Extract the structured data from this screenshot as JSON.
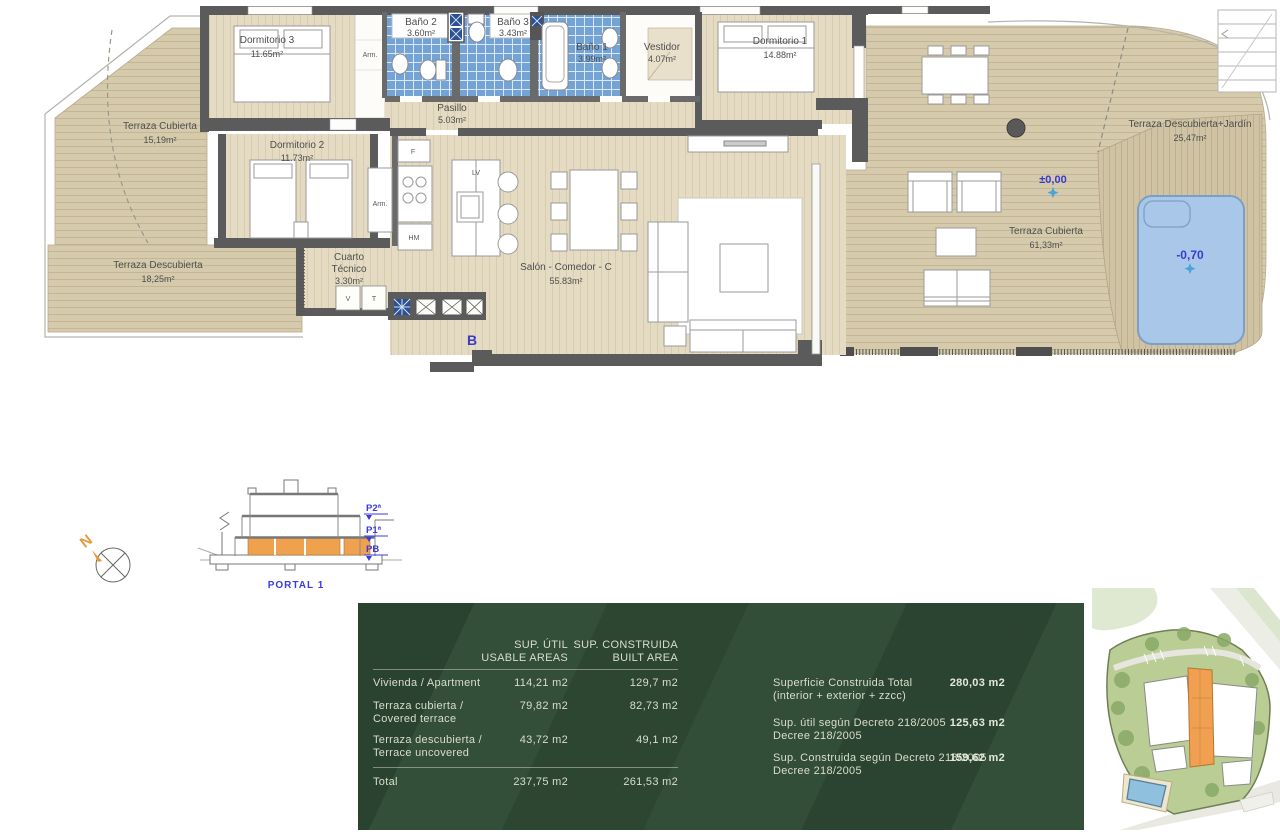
{
  "colors": {
    "accent_orange": "#F0A050",
    "plan_blue_text": "#3A3ACB",
    "tile_blue": "#74A3D6",
    "pool_blue": "#A9C8E9",
    "panel_green": "#2F4A35",
    "wall_gray": "#5B5B5B",
    "deck_beige": "#D5CAAC"
  },
  "floor_plan": {
    "rooms": [
      {
        "name": "Terraza Cubierta",
        "area": "15,19m²"
      },
      {
        "name": "Terraza Descubierta",
        "area": "18,25m²"
      },
      {
        "name": "Dormitorio 3",
        "area": "11.65m²"
      },
      {
        "name": "Baño 2",
        "area": "3.60m²"
      },
      {
        "name": "Baño 3",
        "area": "3.43m²"
      },
      {
        "name": "Baño 1",
        "area": "3.99m²"
      },
      {
        "name": "Vestidor",
        "area": "4.07m²"
      },
      {
        "name": "Dormitorio 1",
        "area": "14.88m²"
      },
      {
        "name": "Pasillo",
        "area": "5.03m²"
      },
      {
        "name": "Dormitorio 2",
        "area": "11.73m²"
      },
      {
        "name": "Salón - Comedor - C",
        "area": "55.83m²"
      },
      {
        "name": "Terraza Cubierta",
        "area": "61,33m²"
      },
      {
        "name": "Terraza Descubierta+Jardín",
        "area": "25,47m²"
      }
    ],
    "cuarto": {
      "l1": "Cuarto",
      "l2": "Técnico",
      "area": "3.30m²"
    },
    "annotations": {
      "arm": "Arm.",
      "f": "F",
      "lv": "LV",
      "hm": "HM",
      "v": "V",
      "t": "T",
      "b": "B",
      "level_main": "±0,00",
      "level_pool": "-0,70"
    }
  },
  "section": {
    "north": "N",
    "levels": [
      "P2ª",
      "P1ª",
      "PB"
    ],
    "portal": "PORTAL 1"
  },
  "areas_table": {
    "col1": [
      "SUP. ÚTIL",
      "USABLE AREAS"
    ],
    "col2": [
      "SUP. CONSTRUIDA",
      "BUILT AREA"
    ],
    "rows": [
      {
        "l1": "Vivienda / Apartment",
        "l2": "",
        "util": "114,21 m2",
        "built": "129,7 m2"
      },
      {
        "l1": "Terraza cubierta /",
        "l2": "Covered terrace",
        "util": "79,82 m2",
        "built": "82,73 m2"
      },
      {
        "l1": "Terraza descubierta /",
        "l2": "Terrace uncovered",
        "util": "43,72 m2",
        "built": "49,1 m2"
      }
    ],
    "total": {
      "label": "Total",
      "util": "237,75 m2",
      "built": "261,53 m2"
    },
    "summary": [
      {
        "l1": "Superficie Construida Total",
        "l2": "(interior + exterior + zzcc)",
        "value": "280,03 m2"
      },
      {
        "l1": "Sup. útil según Decreto 218/2005",
        "l2": "Decree 218/2005",
        "value": "125,63 m2"
      },
      {
        "l1": "Sup. Construida según Decreto 218/2005",
        "l2": "Decree 218/2005",
        "value": "159,62 m2"
      }
    ]
  }
}
